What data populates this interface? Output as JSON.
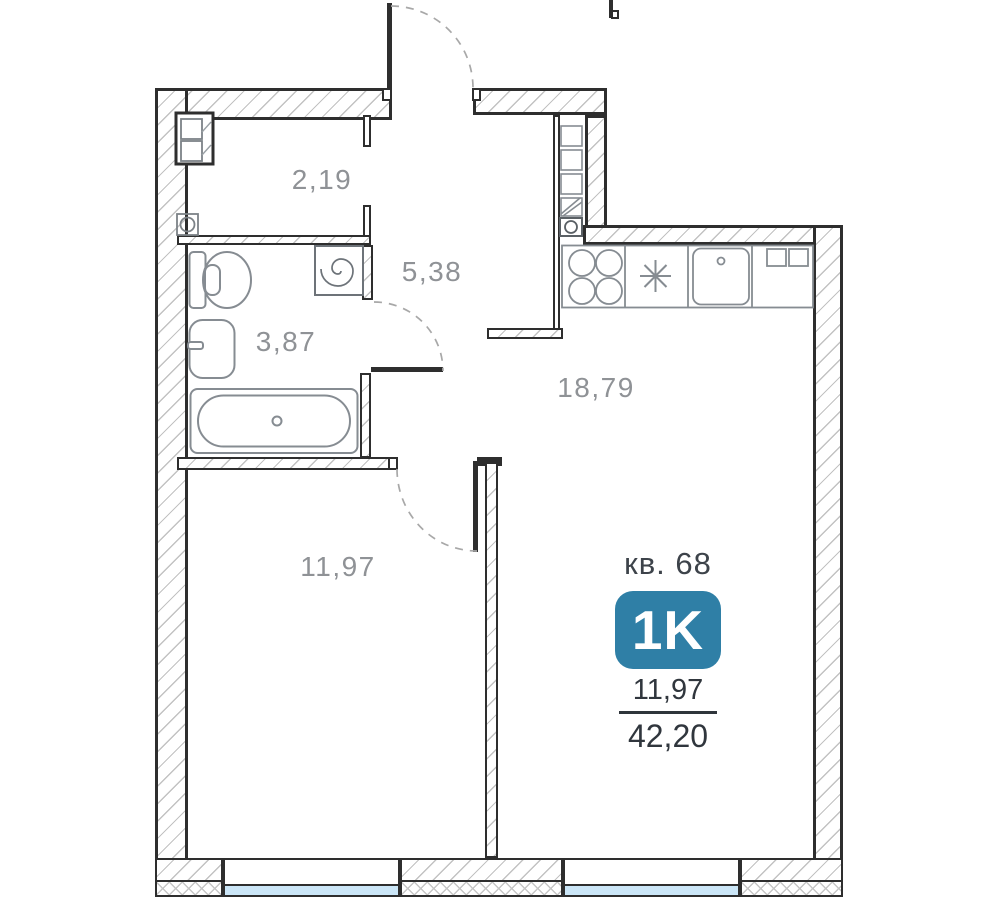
{
  "plan": {
    "apartment": {
      "number_label": "кв. 68",
      "type_badge": "1K",
      "living_area": "11,97",
      "total_area": "42,20"
    },
    "rooms": [
      {
        "name": "entry-hall",
        "area": "2,19"
      },
      {
        "name": "corridor",
        "area": "5,38"
      },
      {
        "name": "bathroom",
        "area": "3,87"
      },
      {
        "name": "kitchen-living-room",
        "area": "18,79"
      },
      {
        "name": "bedroom",
        "area": "11,97"
      }
    ],
    "colors": {
      "badge_blue": "#2f7fa6",
      "window_glass": "#cbe6f7",
      "wall_outline": "#2e2e2e",
      "fixture_stroke": "#868c92",
      "label_gray": "#8f9296"
    },
    "icons": [
      "door-swing-arc",
      "toilet-icon",
      "washbasin-icon",
      "bathtub-icon",
      "washing-machine-icon",
      "stove-icon",
      "asterisk-icon",
      "kitchen-sink-icon",
      "ventilation-shaft-icon",
      "wardrobe-icon",
      "drain-icon",
      "window-glass"
    ]
  }
}
